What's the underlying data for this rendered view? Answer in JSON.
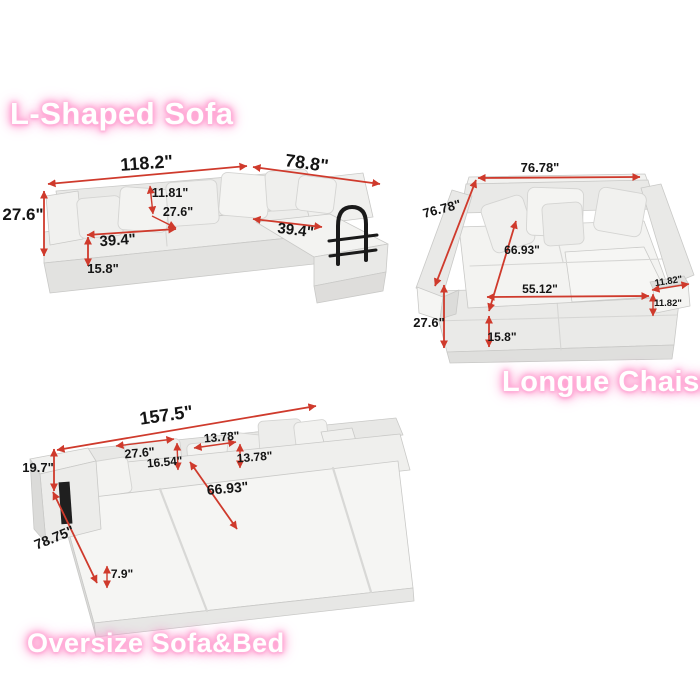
{
  "colors": {
    "background": "#ffffff",
    "arrow_red": "#cf3a2c",
    "label_black": "#141414",
    "title_white": "#ffffff",
    "title_glow_pink": "#ff8fc8",
    "sofa_light": "#f4f4f2",
    "sofa_mid": "#eaeae8",
    "sofa_dark": "#dcdcda",
    "handle_black": "#1a1a1a"
  },
  "sections": {
    "l_shaped": {
      "title": "L-Shaped Sofa",
      "dims": {
        "total_width": "118.2\"",
        "chaise_depth": "78.8\"",
        "overall_height": "27.6\"",
        "back_cushion_height": "11.81\"",
        "seat_depth": "27.6\"",
        "left_seat_width": "39.4\"",
        "right_seat_width": "39.4\"",
        "base_height": "15.8\""
      }
    },
    "longue_chaise": {
      "title": "Longue Chaise",
      "dims": {
        "total_width": "76.78\"",
        "total_depth": "76.78\"",
        "inner_depth": "66.93\"",
        "inner_width": "55.12\"",
        "arm_width": "11.82\"",
        "arm_height": "11.82\"",
        "overall_height": "27.6\"",
        "base_height": "15.8\""
      }
    },
    "oversize": {
      "title": "Oversize Sofa&Bed",
      "dims": {
        "total_width": "157.5\"",
        "back_height": "19.7\"",
        "back_cushion_width": "27.6\"",
        "back_cushion_height": "16.54\"",
        "pillow_width": "13.78\"",
        "pillow_height": "13.78\"",
        "bed_length": "66.93\"",
        "total_depth": "78.75\"",
        "mattress_height": "7.9\""
      }
    }
  }
}
